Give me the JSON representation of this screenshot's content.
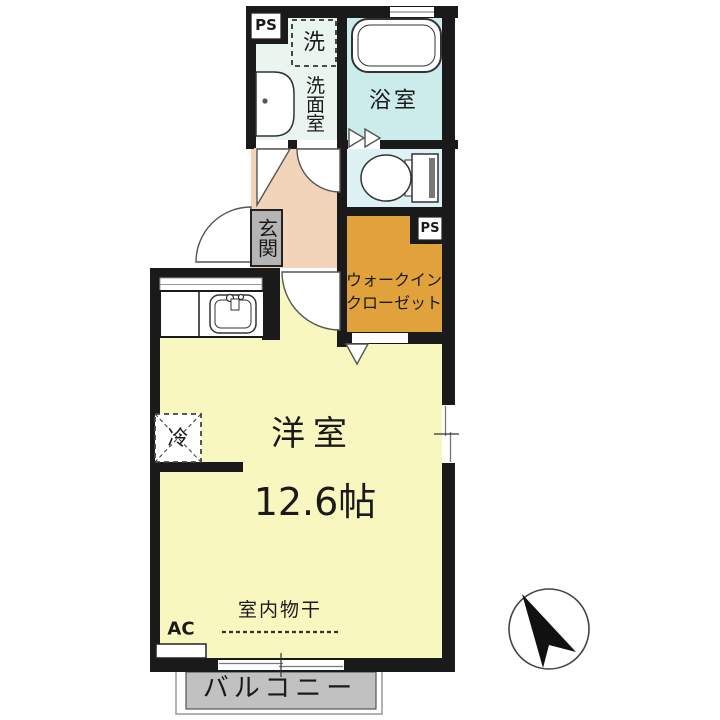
{
  "document": {
    "type": "floorplan",
    "unit_size_label": "12.6帖"
  },
  "labels": {
    "ps_top": "PS",
    "washer": "洗",
    "washroom": "洗面室",
    "bathroom": "浴室",
    "genkan": "玄関",
    "wic_line1": "ウォークイン",
    "wic_line2": "クローゼット",
    "ps_closet": "PS",
    "fridge": "冷",
    "main_room": "洋室",
    "room_size": "12.6帖",
    "ac": "AC",
    "indoor_drying": "室内物干",
    "balcony": "バルコニー"
  },
  "colors": {
    "wall": "#1a1a1a",
    "main_room": "#f9f7c0",
    "hallway": "#f2d4ba",
    "closet": "#e2a23b",
    "bathroom": "#cbecea",
    "toilet": "#def2f6",
    "washroom": "#e9f5ee",
    "balcony": "#c1c1c1",
    "genkan_box": "#b5b5b5",
    "line": "#555555"
  }
}
